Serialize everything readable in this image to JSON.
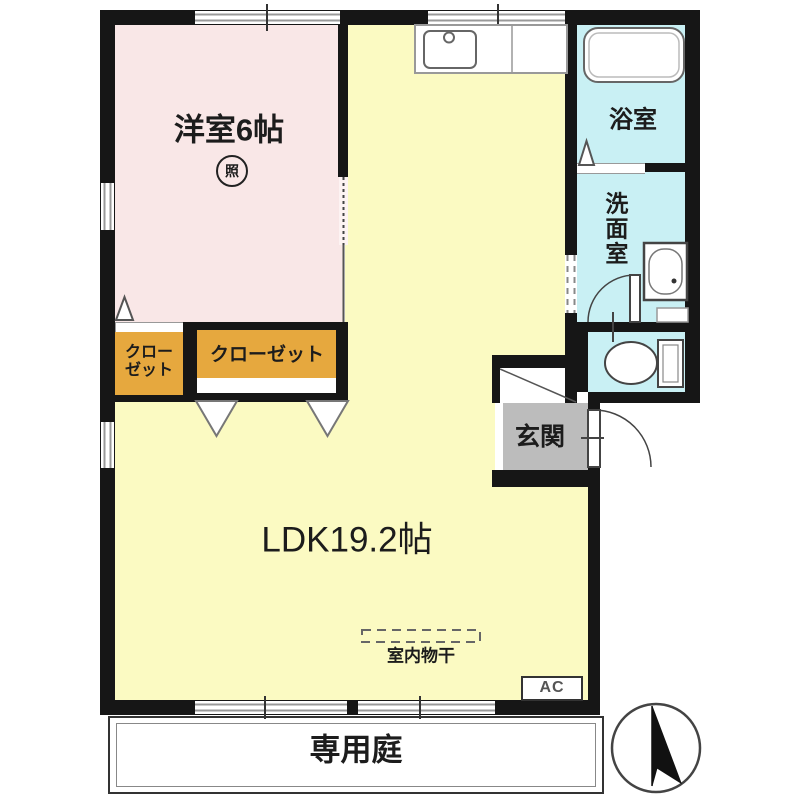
{
  "floorplan": {
    "western_room_label": "洋室6帖",
    "lighting_symbol": "照",
    "closet_small_line1": "クロー",
    "closet_small_line2": "ゼット",
    "closet_large_label": "クローゼット",
    "ldk_label": "LDK19.2帖",
    "bathroom_label": "浴室",
    "washroom_label": "洗面室",
    "entrance_label": "玄関",
    "indoor_drying_label": "室内物干",
    "ac_label": "AC",
    "garden_label": "専用庭"
  },
  "colors": {
    "wall": "#161616",
    "western_room": "#f9e7e7",
    "ldk": "#fbfac2",
    "wet_area": "#c9f0f4",
    "closet": "#e6a83e",
    "entrance": "#bcbcbc",
    "text": "#1c1c1c"
  }
}
